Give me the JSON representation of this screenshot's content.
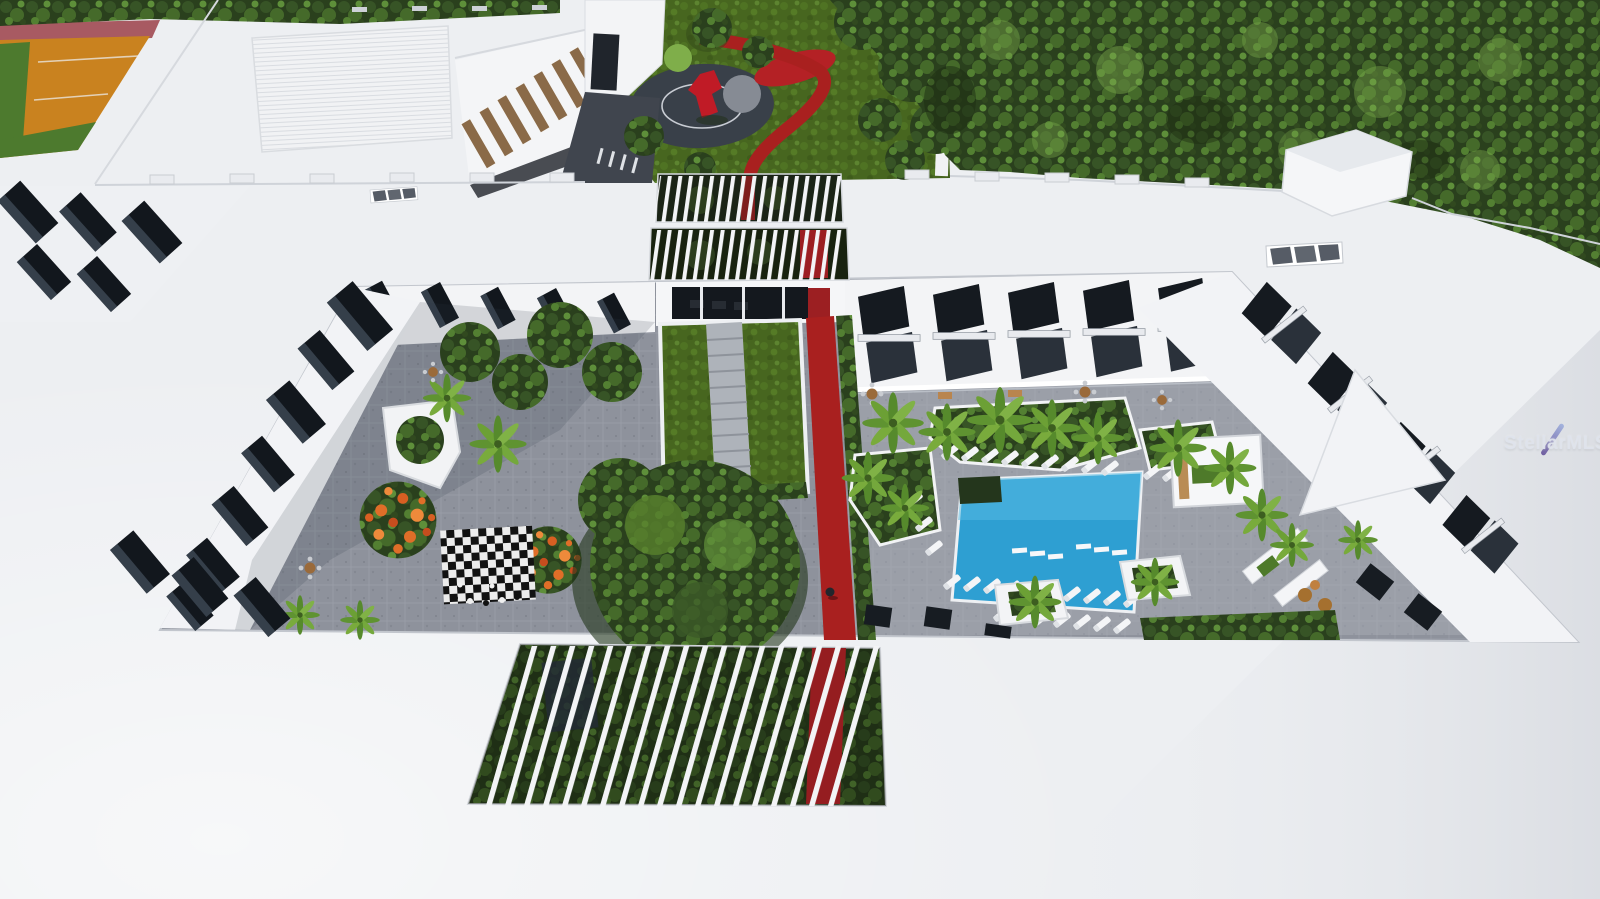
{
  "scene": {
    "type": "aerial-3d-architectural-rendering",
    "subject": "Condominium complex courtyard with pool, lawn, giant chess board, pergolas, playground garden and sports court",
    "watermark": {
      "text": "StellarMLS"
    },
    "colors": {
      "roof": "#edeff2",
      "roof_shade": "#d9dce1",
      "forest_green": "#2c421f",
      "lawn_green": "#47661f",
      "paver_gray": "#8e929c",
      "pool_blue": "#2e9fd2",
      "red_path": "#a9201f",
      "sport_court_orange": "#c9821f",
      "court_green": "#4d7a2e",
      "track_rose": "#a85a62",
      "window_glass": "#151a20",
      "louver_brown": "#8a6a48",
      "palm_green": "#6ca035",
      "flower_orange": "#e06e28",
      "chess_black": "#121212",
      "chess_white": "#ececec",
      "watermark_blue": "#8b9bce"
    },
    "amenities": [
      "swimming-pool",
      "sun-loungers",
      "giant-chess-board",
      "central-lawn",
      "red-jogging-path",
      "pergola-openings",
      "playground",
      "red-sculpture",
      "sports-court",
      "palm-planters",
      "cabana",
      "dining-terraces"
    ]
  }
}
